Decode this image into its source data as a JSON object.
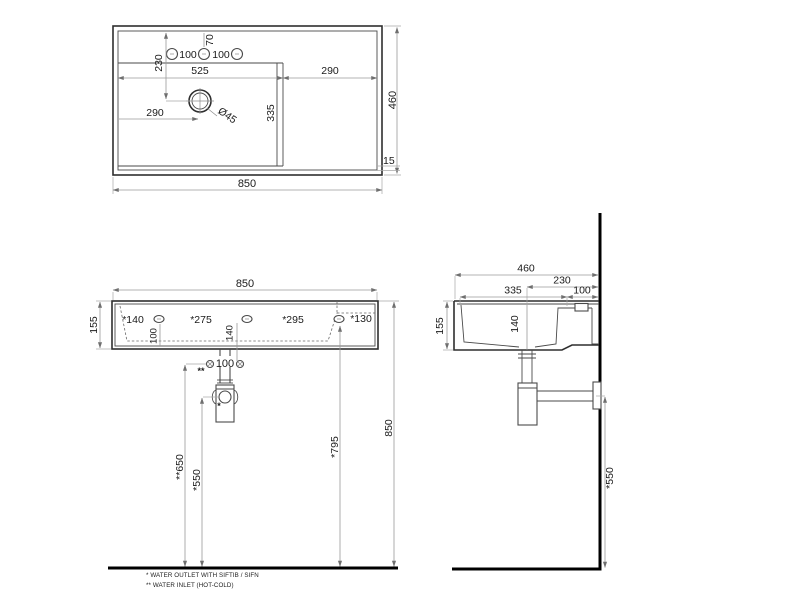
{
  "title": "washbasin-technical-drawing",
  "colors": {
    "background": "#ffffff",
    "object_line": "#2e2e2e",
    "dim_line": "#9a9a9a",
    "wall_floor": "#000000"
  },
  "top_view": {
    "dim_total_width": "850",
    "dim_total_depth": "460",
    "dim_front_rim": "15",
    "dim_hole_spacing_left": "100",
    "dim_hole_spacing_right": "100",
    "dim_hole_offset": "70",
    "dim_drain_back": "230",
    "dim_bowl_width": "525",
    "dim_deck_width": "290",
    "dim_drain_left": "290",
    "dim_drain_diameter": "Ø45",
    "dim_bowl_depth": "335"
  },
  "front_view": {
    "dim_total_width": "850",
    "dim_height": "155",
    "dim_hole_140": "*140",
    "dim_hole_275": "*275",
    "dim_hole_295": "*295",
    "dim_hole_130": "*130",
    "dim_hole_height": "100",
    "dim_mid_height": "140",
    "dim_inlet_spacing": "100",
    "marker_inlet": "**",
    "marker_outlet": "*",
    "dim_inlet_height": "**650",
    "dim_outlet_height": "*550",
    "dim_holes_floor": "*795",
    "dim_rim_floor": "850"
  },
  "side_view": {
    "dim_total_depth": "460",
    "dim_drain_wall": "230",
    "dim_bowl_depth": "335",
    "dim_ledge": "100",
    "dim_height": "155",
    "dim_inner_depth": "140",
    "dim_outlet_height": "*550"
  },
  "footnotes": {
    "line1": "*  WATER OUTLET WITH SIFTIB / SIFN",
    "line2": "** WATER INLET  (HOT-COLD)"
  }
}
